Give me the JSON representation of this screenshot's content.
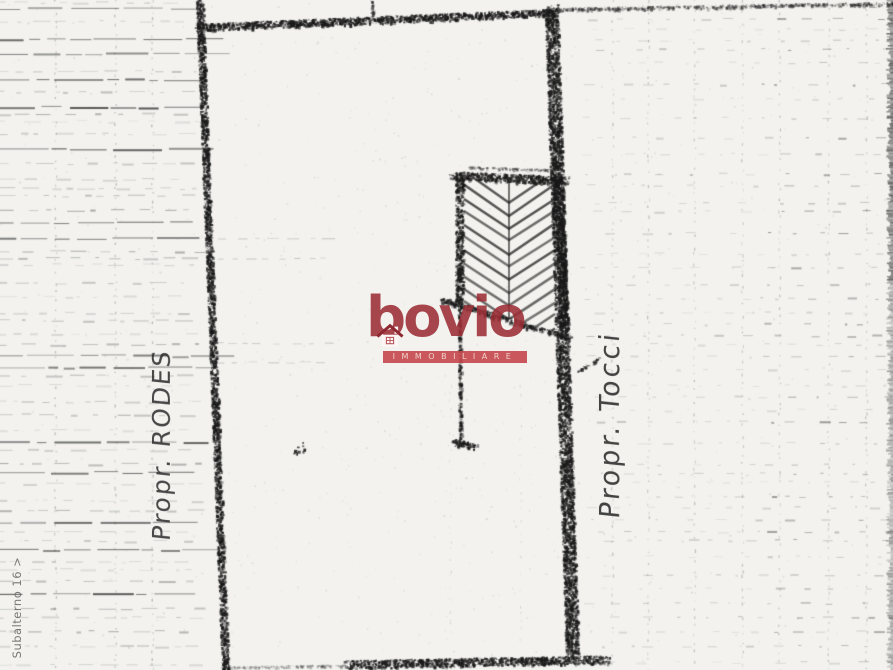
{
  "page": {
    "width": 893,
    "height": 670,
    "paper_color": "#f3f2ef",
    "ink_color": "#1a1a1a"
  },
  "labels": {
    "left_owner": "Propr. RODES",
    "right_owner": "Propr. Tocci",
    "subalterno": "Subalterno 16 >"
  },
  "watermark": {
    "brand": "bovio",
    "banner_text": "IMMOBILIARE",
    "brand_color": "#9b2c34",
    "banner_color": "#c4464b",
    "banner_text_color": "#f2d3cd"
  },
  "scan": {
    "seed": 7,
    "left_band": {
      "x0": 0,
      "x1": 196
    },
    "left_columns": [
      55,
      115,
      152
    ],
    "right_band": {
      "x0": 580,
      "x1": 888
    },
    "right_columns": [
      612,
      648,
      694,
      742,
      779,
      828,
      866
    ],
    "interior_columns": [
      450,
      520
    ],
    "edge_strip": {
      "x0": 885,
      "x1": 893
    },
    "interior_dash_rows": [
      238,
      258,
      343,
      362
    ]
  },
  "plan": {
    "borders": [
      {
        "name": "left-boundary",
        "x1": 199,
        "y1": 0,
        "x2": 225,
        "y2": 670,
        "w": 7,
        "a": 0.88
      },
      {
        "name": "top-boundary",
        "x1": 196,
        "y1": 27,
        "x2": 554,
        "y2": 12,
        "w": 7,
        "a": 0.9
      },
      {
        "name": "top-boundary-ext",
        "x1": 554,
        "y1": 9,
        "x2": 893,
        "y2": 3,
        "w": 3,
        "a": 0.5
      },
      {
        "name": "right-boundary",
        "x1": 551,
        "y1": 10,
        "x2": 572,
        "y2": 656,
        "w": 13,
        "a": 0.85
      },
      {
        "name": "bottom-boundary",
        "x1": 347,
        "y1": 664,
        "x2": 606,
        "y2": 659,
        "w": 8,
        "a": 0.85
      },
      {
        "name": "bottom-boundary-ext",
        "x1": 228,
        "y1": 667,
        "x2": 347,
        "y2": 665,
        "w": 2,
        "a": 0.3
      },
      {
        "name": "top-tick",
        "x1": 371,
        "y1": 0,
        "x2": 372,
        "y2": 14,
        "w": 3,
        "a": 0.7
      },
      {
        "name": "annotation-stroke",
        "x1": 577,
        "y1": 371,
        "x2": 600,
        "y2": 357,
        "w": 2,
        "a": 0.7
      }
    ],
    "hatched_structure": {
      "outline": [
        [
          459,
          174
        ],
        [
          564,
          179
        ],
        [
          564,
          334
        ],
        [
          441,
          301
        ]
      ],
      "edges": [
        {
          "x1": 452,
          "y1": 175,
          "x2": 566,
          "y2": 180,
          "w": 8,
          "a": 0.85
        },
        {
          "x1": 459,
          "y1": 174,
          "x2": 459,
          "y2": 303,
          "w": 8,
          "a": 0.85
        },
        {
          "x1": 557,
          "y1": 176,
          "x2": 564,
          "y2": 332,
          "w": 9,
          "a": 0.8
        },
        {
          "x1": 441,
          "y1": 299,
          "x2": 569,
          "y2": 338,
          "w": 5,
          "a": 0.8
        },
        {
          "x1": 468,
          "y1": 167,
          "x2": 560,
          "y2": 170,
          "w": 2,
          "a": 0.4
        }
      ],
      "spine": {
        "x": 509,
        "y1": 182,
        "y2": 330
      },
      "chevrons": {
        "left_x": 464,
        "apex_x": 509,
        "right_x": 555,
        "start_y": 172,
        "count": 13,
        "step": 13,
        "drop": 30,
        "w": 2.5,
        "a": 0.7
      }
    },
    "wall": {
      "line": {
        "x1": 459,
        "y1": 303,
        "x2": 460,
        "y2": 438,
        "w": 3,
        "a": 0.8
      },
      "foot": {
        "x1": 454,
        "y1": 442,
        "x2": 474,
        "y2": 446,
        "w": 7,
        "a": 0.85
      }
    },
    "point_mark": {
      "x": 293,
      "y": 442,
      "size": 11
    }
  }
}
